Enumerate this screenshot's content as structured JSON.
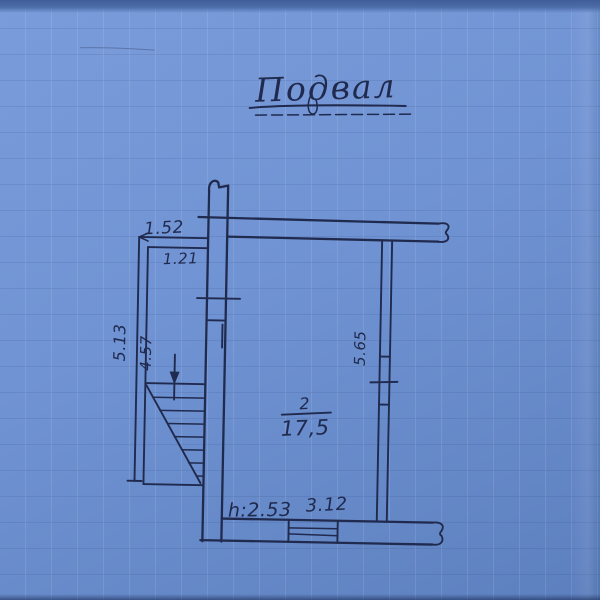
{
  "title": "Подвал",
  "room": {
    "number": "2",
    "area": "17,5"
  },
  "dimensions": {
    "annex_width_outer": "1.52",
    "annex_width_inner": "1.21",
    "left_height_outer": "5.13",
    "left_height_inner": "4.57",
    "right_height": "5.65",
    "ceiling_height": "h:2.53",
    "bottom_width": "3.12"
  },
  "colors": {
    "paper": "#6f92d2",
    "ink": "#202a4e",
    "top_edge": "#4c6da9"
  }
}
